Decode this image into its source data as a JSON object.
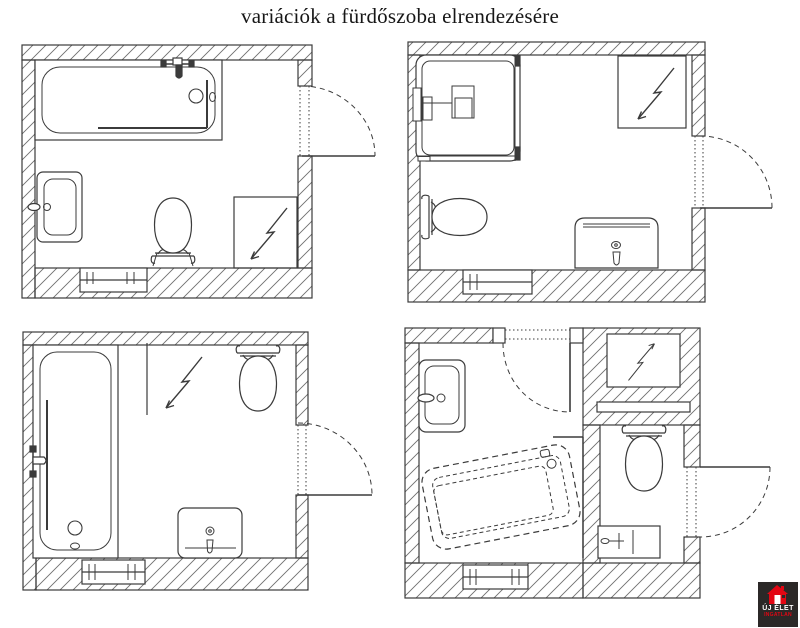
{
  "title": "variációk a fürdőszoba elrendezésére",
  "logo": {
    "line1": "ÚJ ÉLET",
    "line2": "INGATLAN",
    "background": "#2b2827",
    "accent_red": "#e30613",
    "text_white": "#ffffff"
  },
  "colors": {
    "drawing_line": "#3b3b3b",
    "wall_hatch": "#6f6f6f",
    "background": "#ffffff"
  },
  "plans": [
    {
      "position": "top-left",
      "fixtures": [
        "bathtub",
        "washbasin",
        "toilet",
        "mirror",
        "window",
        "door"
      ]
    },
    {
      "position": "top-right",
      "fixtures": [
        "shower-cabin",
        "mirror",
        "toilet",
        "vanity-basin",
        "window",
        "door"
      ]
    },
    {
      "position": "bottom-left",
      "fixtures": [
        "bathtub",
        "mirror",
        "toilet",
        "washbasin",
        "window",
        "door"
      ]
    },
    {
      "position": "bottom-right",
      "fixtures": [
        "washbasin",
        "corner-bathtub",
        "mirror",
        "shelf",
        "toilet",
        "hand-basin",
        "window",
        "entry-door",
        "wc-door"
      ]
    }
  ]
}
